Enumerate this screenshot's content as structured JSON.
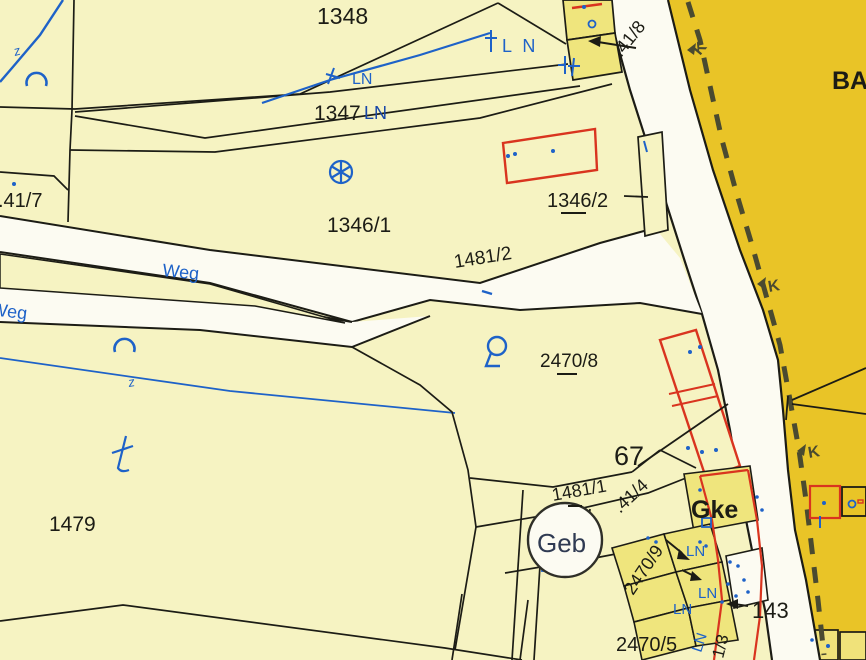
{
  "map": {
    "type": "cadastral-map",
    "labels": {
      "p1348": "1348",
      "p1347": "1347",
      "p1346_1": "1346/1",
      "p1346_2": "1346/2",
      "p1481_2": "1481/2",
      "p41_7": ".41/7",
      "p41_8": ".41/8",
      "p41_4": ".41/4",
      "p2470_8": "2470/8",
      "p2470_9": "2470/9",
      "p2470_5": "2470/5",
      "p1479": "1479",
      "p67": "67",
      "p1481_1": "1481/1",
      "p143": "143",
      "p1_3": "1/3",
      "ba": "BA",
      "gke": "Gke",
      "geb": "Geb",
      "ln": "LN",
      "l_n": "L N",
      "weg": "Weg",
      "marker_k": "K",
      "tick_z": "z"
    },
    "colors": {
      "parcel_pale": "#f6f3c2",
      "parcel_yellow": "#efe57d",
      "ochre": "#e9c427",
      "road_white": "#fcfbf2",
      "line_black": "#1c1c15",
      "symbol_blue": "#1e62c8",
      "label_blue_dark": "#1746a8",
      "building_red": "#d9341f",
      "boundary_dash": "#4a4a30"
    }
  }
}
